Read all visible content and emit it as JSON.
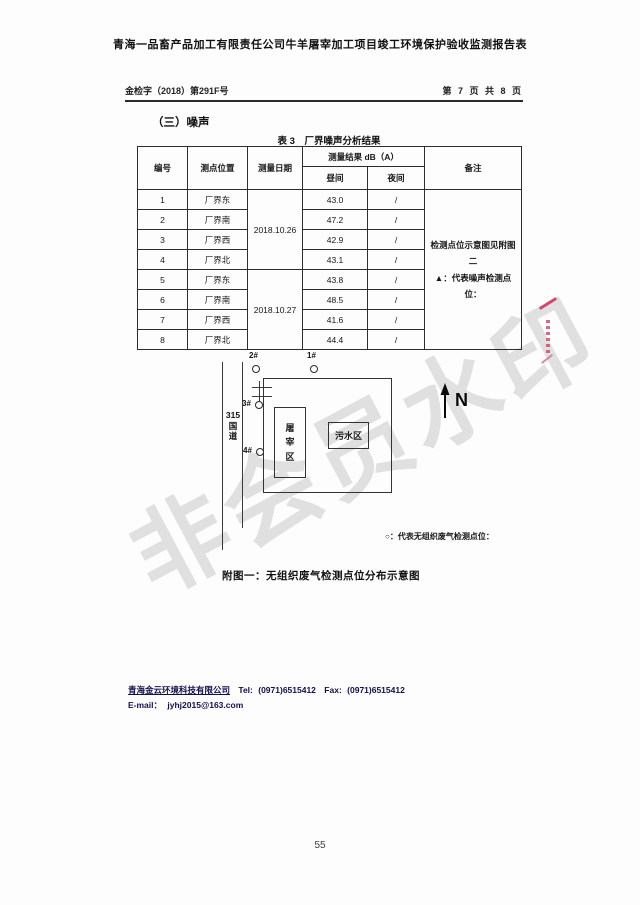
{
  "doc": {
    "title": "青海一品畜产品加工有限责任公司牛羊屠宰加工项目竣工环境保护验收监测报告表",
    "header": {
      "left": "金检字（2018）第291F号",
      "right": "第 7 页 共 8 页"
    },
    "page_number": "55"
  },
  "section": {
    "heading": "（三）噪声",
    "table_title": "表 3　厂界噪声分析结果"
  },
  "table": {
    "headers": {
      "no": "编号",
      "location": "测点位置",
      "date": "测量日期",
      "result": "测量结果 dB（A）",
      "day": "昼间",
      "night": "夜间",
      "remark": "备注"
    },
    "dates": [
      "2018.10.26",
      "2018.10.27"
    ],
    "rows": [
      {
        "no": "1",
        "location": "厂界东",
        "day": "43.0",
        "night": "/"
      },
      {
        "no": "2",
        "location": "厂界南",
        "day": "47.2",
        "night": "/"
      },
      {
        "no": "3",
        "location": "厂界西",
        "day": "42.9",
        "night": "/"
      },
      {
        "no": "4",
        "location": "厂界北",
        "day": "43.1",
        "night": "/"
      },
      {
        "no": "5",
        "location": "厂界东",
        "day": "43.8",
        "night": "/"
      },
      {
        "no": "6",
        "location": "厂界南",
        "day": "48.5",
        "night": "/"
      },
      {
        "no": "7",
        "location": "厂界西",
        "day": "41.6",
        "night": "/"
      },
      {
        "no": "8",
        "location": "厂界北",
        "day": "44.4",
        "night": "/"
      }
    ],
    "remark": {
      "line1": "检测点位示意图见附图二",
      "line2": "▲：代表噪声检测点位："
    }
  },
  "diagram": {
    "labels": {
      "p1": "1#",
      "p2": "2#",
      "p3": "3#",
      "p4": "4#"
    },
    "road_label": "315\n国\n道",
    "slaughter": "屠\n宰\n区",
    "sewage": "污水区",
    "north": "N",
    "legend": "○：代表无组织废气检测点位：",
    "caption": "附图一：无组织废气检测点位分布示意图"
  },
  "footer": {
    "company": "青海金云环境科技有限公司",
    "tel_label": "Tel:",
    "tel": "(0971)6515412",
    "fax_label": "Fax:",
    "fax": "(0971)6515412",
    "email_label": "E-mail：",
    "email": "jyhj2015@163.com"
  },
  "watermark": "非会员水印"
}
